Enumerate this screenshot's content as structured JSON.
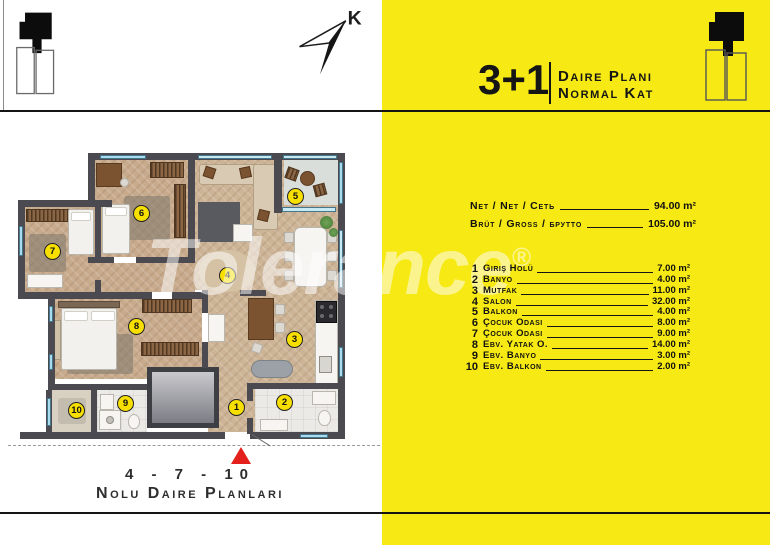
{
  "header": {
    "unit": "3+1",
    "line1": "Daire Planı",
    "line2": "Normal Kat"
  },
  "compass": {
    "label": "K"
  },
  "area_summary": [
    {
      "label": "Net / Net / Сеть",
      "value": "94.00 m²"
    },
    {
      "label": "Brüt / Gross / брутто",
      "value": "105.00 m²"
    }
  ],
  "rooms": [
    {
      "no": "1",
      "name": "Giriş Holü",
      "area": "7.00 m²"
    },
    {
      "no": "2",
      "name": "Banyo",
      "area": "4.00 m²"
    },
    {
      "no": "3",
      "name": "Mutfak",
      "area": "11.00 m²"
    },
    {
      "no": "4",
      "name": "Salon",
      "area": "32.00 m²"
    },
    {
      "no": "5",
      "name": "Balkon",
      "area": "4.00 m²"
    },
    {
      "no": "6",
      "name": "Çocuk Odası",
      "area": "8.00 m²"
    },
    {
      "no": "7",
      "name": "Çocuk Odası",
      "area": "9.00 m²"
    },
    {
      "no": "8",
      "name": "Ebv. Yatak O.",
      "area": "14.00 m²"
    },
    {
      "no": "9",
      "name": "Ebv. Banyo",
      "area": "3.00 m²"
    },
    {
      "no": "10",
      "name": "Ebv. Balkon",
      "area": "2.00 m²"
    }
  ],
  "footer": {
    "line1": "4 - 7 - 10",
    "line2": "Nolu Daire Planları"
  },
  "watermark": {
    "text": "Tolerance",
    "reg": "®"
  },
  "colors": {
    "panel_yellow": "#f6e914",
    "badge_yellow": "#f7df00",
    "entrance_red": "#e3201b",
    "wall_gray": "#4a4a50",
    "window_blue": "#a8dcee"
  }
}
